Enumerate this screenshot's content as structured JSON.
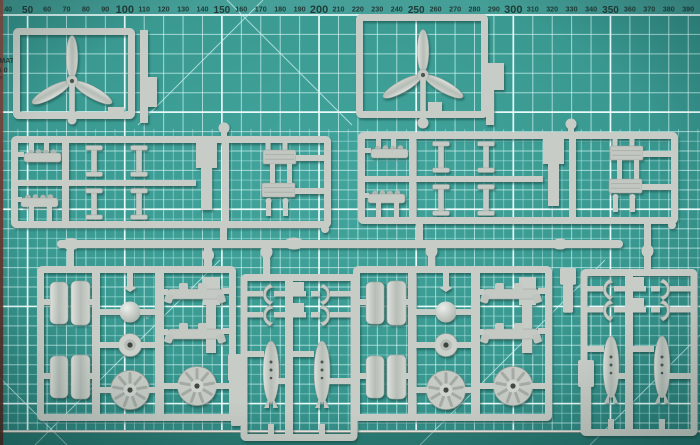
{
  "ruler": {
    "labels": [
      40,
      50,
      60,
      70,
      80,
      90,
      100,
      110,
      120,
      130,
      140,
      150,
      160,
      170,
      180,
      190,
      200,
      210,
      220,
      230,
      240,
      250,
      260,
      270,
      280,
      290,
      300,
      310,
      320,
      330,
      340,
      350,
      360,
      370,
      380,
      390
    ]
  },
  "mat": {
    "edge_text": [
      "G MAT",
      "45 0",
      "3°"
    ],
    "angle_label": "45°"
  },
  "palette": {
    "mat_center": "#42a49c",
    "mat_mid": "#3a9a92",
    "mat_edge": "#2b7f79",
    "grid_fine": "rgba(176,232,229,0.50)",
    "grid_coarse": "rgba(210,244,242,0.70)",
    "grid_accent": "rgba(240,255,254,0.92)",
    "ruler_text": "#1c2e2b",
    "sprue_grey": "#c8ccc6",
    "sprue_grey_dark": "#a9aea8",
    "sprue_detail_dark": "#4e5551",
    "mat_edge_line": "#f2e4df",
    "side_strip_top": "#8a4a40",
    "side_strip_bottom": "#4b241f"
  },
  "sprue_parts": [
    "propeller-3-blade",
    "spinner-dome",
    "engine-cowling-half",
    "radial-engine-disc",
    "wheel-hub",
    "exhaust-stub-row",
    "radiator-block",
    "drop-bomb",
    "sway-brace-clip",
    "engine-mount-bracket",
    "i-beam-post",
    "step-tab"
  ]
}
